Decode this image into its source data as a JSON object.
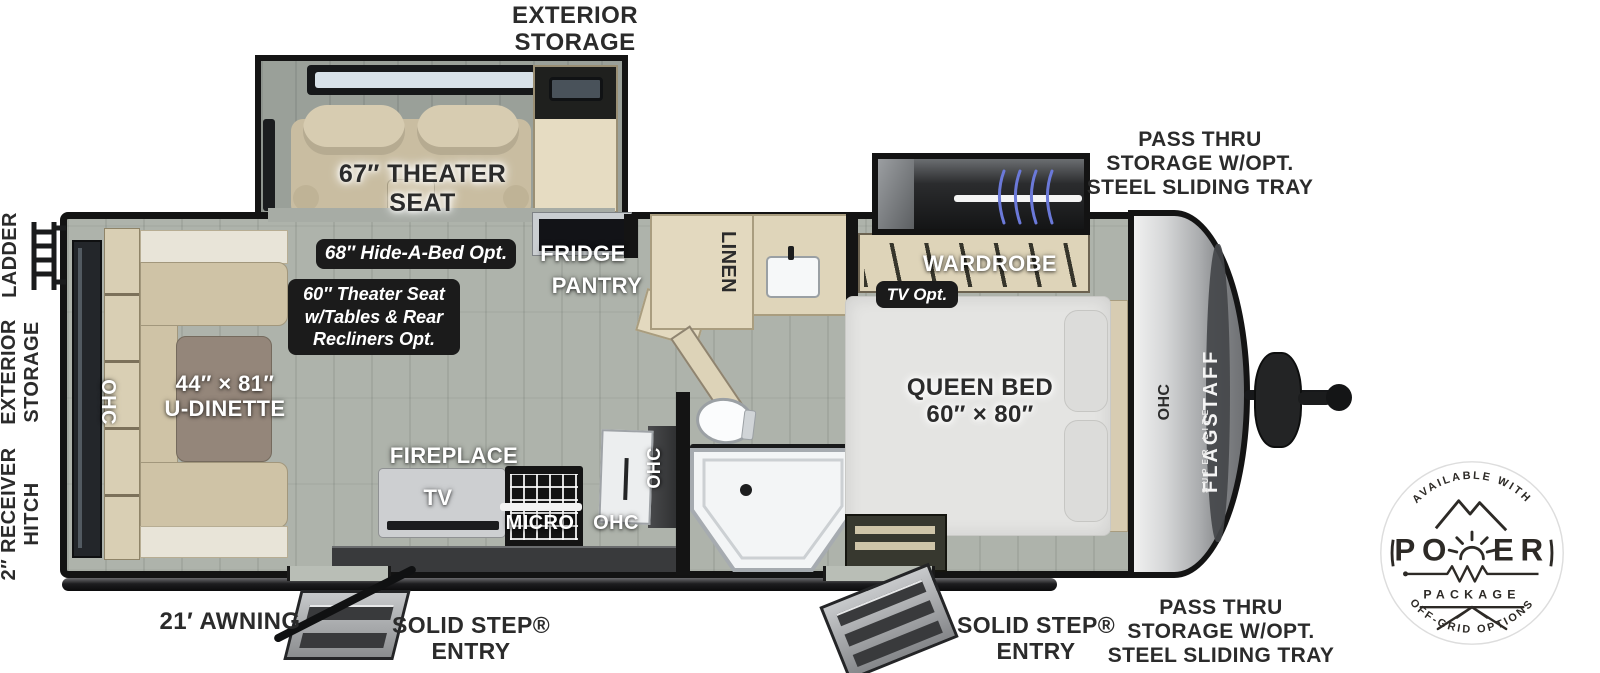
{
  "colors": {
    "ink": "#2b2b2b",
    "floor": "#aeb3ab",
    "furniture_tan": "#cfc3a6",
    "cabinet_wood": "#e3d9bf",
    "pill_bg": "#1b1b1b",
    "coil_blue": "#6b79d9",
    "badge_ink": "#2d2a26"
  },
  "top": {
    "exterior_storage": [
      "EXTERIOR",
      "STORAGE"
    ],
    "pass_thru": [
      "PASS THRU",
      "STORAGE W/OPT.",
      "STEEL SLIDING TRAY"
    ]
  },
  "left": {
    "ladder": "LADDER",
    "exterior_storage": [
      "EXTERIOR",
      "STORAGE"
    ],
    "receiver_hitch": [
      "2″ RECEIVER",
      "HITCH"
    ]
  },
  "bottom": {
    "awning": "21′ AWNING",
    "entry_front": [
      "SOLID STEP®",
      "ENTRY"
    ],
    "entry_rear": [
      "SOLID STEP®",
      "ENTRY"
    ],
    "pass_thru": [
      "PASS THRU",
      "STORAGE W/OPT.",
      "STEEL SLIDING TRAY"
    ]
  },
  "interior": {
    "theater_seat": [
      "67″ THEATER",
      "SEAT"
    ],
    "hide_a_bed_opt": "68″ Hide-A-Bed Opt.",
    "theater_opt": [
      "60″ Theater Seat",
      "w/Tables & Rear",
      "Recliners Opt."
    ],
    "fridge": "FRIDGE",
    "pantry": "PANTRY",
    "linen": "LINEN",
    "wardrobe": "WARDROBE",
    "tv_opt": "TV Opt.",
    "queen_bed": [
      "QUEEN BED",
      "60″ × 80″"
    ],
    "u_dinette": [
      "44″ × 81″",
      "U-DINETTE"
    ],
    "fireplace": "FIREPLACE",
    "tv": "TV",
    "micro": "MICRO",
    "ohc_dinette": "OHC",
    "ohc_sink": "OHC",
    "ohc_kitchen": "OHC",
    "ohc_front": "OHC"
  },
  "brand": {
    "name": "FLAGSTAFF",
    "sub": "SUPER LITE"
  },
  "badge": {
    "arc_top": "AVAILABLE WITH",
    "power_left": "PO",
    "power_right": "ER",
    "package": "PACKAGE",
    "arc_bottom": "OFF-GRID OPTIONS"
  }
}
